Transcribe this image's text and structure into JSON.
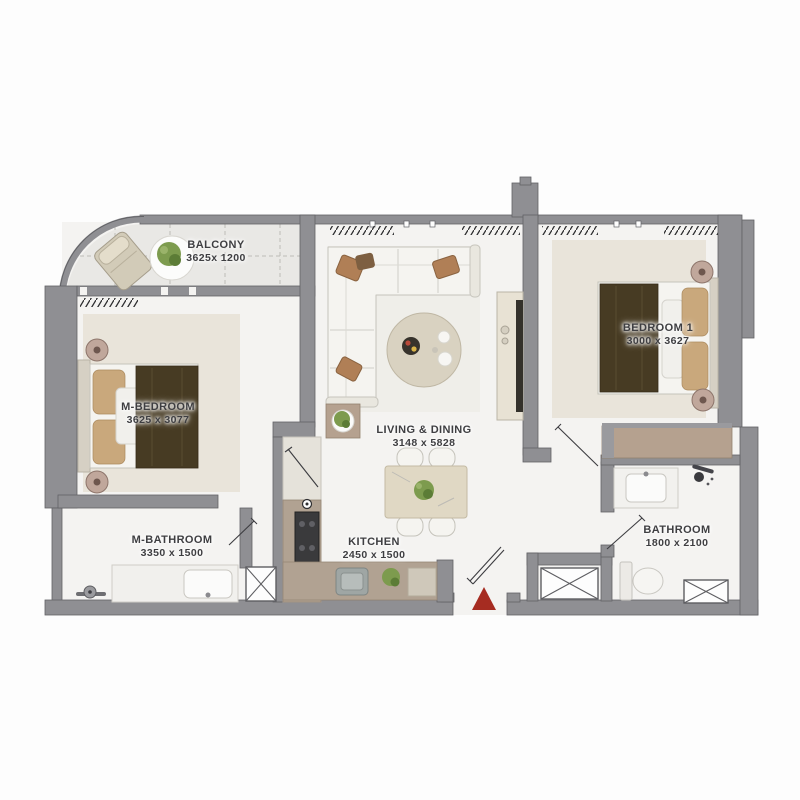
{
  "plan": {
    "title": "Apartment floor plan",
    "rooms": [
      {
        "id": "balcony",
        "name": "BALCONY",
        "dims": "3625x 1200"
      },
      {
        "id": "m_bedroom",
        "name": "M-BEDROOM",
        "dims": "3625 x 3077"
      },
      {
        "id": "living_dining",
        "name": "LIVING & DINING",
        "dims": "3148 x 5828"
      },
      {
        "id": "bedroom_1",
        "name": "BEDROOM 1",
        "dims": "3000 x 3627"
      },
      {
        "id": "m_bathroom",
        "name": "M-BATHROOM",
        "dims": "3350 x 1500"
      },
      {
        "id": "kitchen",
        "name": "KITCHEN",
        "dims": "2450 x 1500"
      },
      {
        "id": "bathroom",
        "name": "BATHROOM",
        "dims": "1800 x 2100"
      }
    ],
    "icons": {
      "entrance": "red-triangle-entrance-marker",
      "shaft": "x-crossed-service-shaft",
      "curtain": "hatched-curtain-symbol",
      "door": "door-swing-leaf"
    },
    "colors": {
      "wall": "#8f8f93",
      "wall_edge": "#626266",
      "floor": "#f4f3f1",
      "balcony": "#e9e8e5",
      "rug": "#e9e4da",
      "white_furn": "#f5f4f0",
      "furn_stroke": "#c5c3bb",
      "blanket": "#473b23",
      "pillow": "#c9a87c",
      "wood": "#b5a18f",
      "counter": "#b1a292",
      "plant": "#7d9b4e",
      "plant_dark": "#5c7c36",
      "red": "#a62c21",
      "tv": "#34312b",
      "line": "#3c3c40",
      "label": "#3e3e41"
    }
  }
}
